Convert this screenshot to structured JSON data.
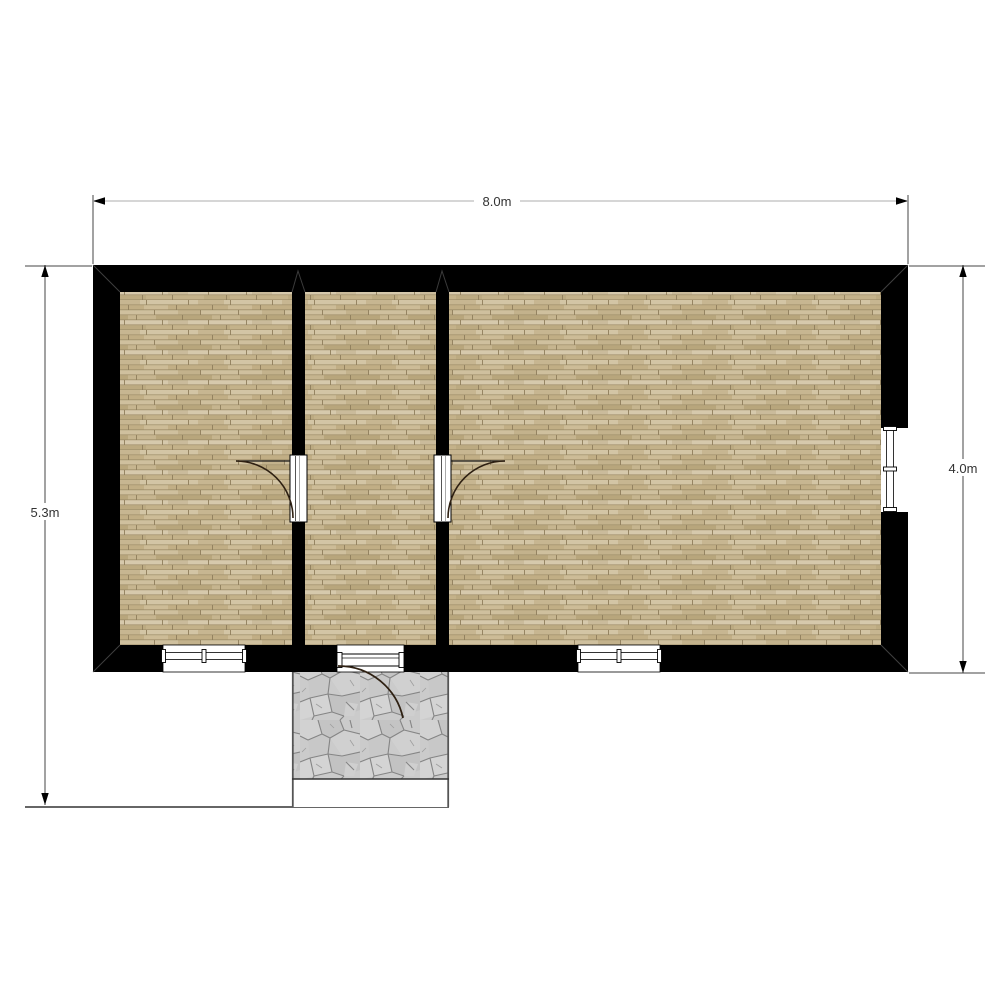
{
  "drawing": {
    "type": "architectural-floor-plan",
    "dimension_labels": {
      "top_width": "8.0m",
      "left_height": "5.3m",
      "right_height": "4.0m"
    }
  },
  "rooms": [
    {
      "name": "room-left",
      "floor": "wood-parquet"
    },
    {
      "name": "room-middle",
      "floor": "wood-parquet"
    },
    {
      "name": "room-right",
      "floor": "wood-parquet"
    }
  ],
  "features": {
    "interior_doors": 2,
    "entrance_door": 1,
    "windows": 3,
    "patio_surface": "flagstone"
  },
  "colors": {
    "wall": "#000000",
    "wood_base": "#c9b893",
    "wood_joint": "#8f7e5c",
    "patio_stone": "#cbcbcb",
    "patio_joint": "#858585",
    "patio_border": "#555555",
    "dimension_line_top": "#bdbdbd",
    "dimension_line_side": "#444444",
    "dimension_text": "#333333",
    "arrow": "#000000",
    "door_arc": "#2e2012",
    "background": "#ffffff"
  }
}
